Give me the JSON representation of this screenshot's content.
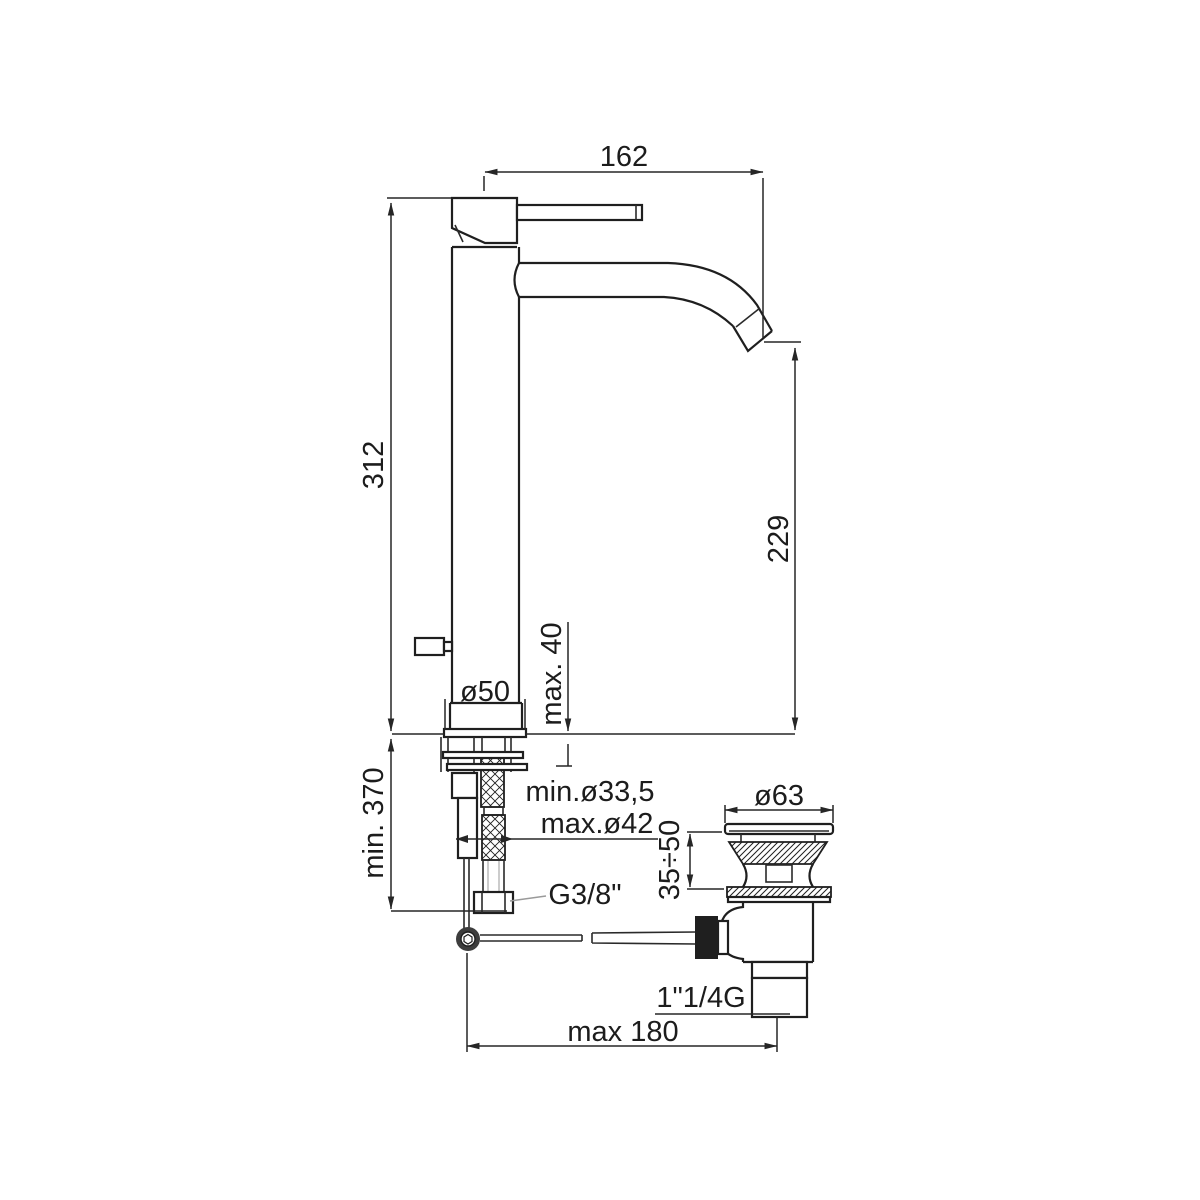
{
  "drawing": {
    "title": "Tall single-lever basin mixer with pop-up waste - dimensional side elevation",
    "type": "technical-dimension-drawing",
    "units": "mm",
    "background_color": "#ffffff",
    "line_color": "#1f1f1f",
    "dims": {
      "spout_reach": "162",
      "total_height": "312",
      "spout_outlet_height": "229",
      "max_deck_thickness": "max. 40",
      "base_diameter": "ø50",
      "min_clearance_below_deck": "min. 370",
      "tap_hole_min": "min.ø33,5",
      "tap_hole_max": "max.ø42",
      "supply_connection_thread": "G3/8\"",
      "waste_flange_diameter": "ø63",
      "basin_thickness_range": "35÷50",
      "waste_outlet_thread": "1\"1/4G",
      "rod_max_horizontal_reach": "max 180"
    }
  }
}
